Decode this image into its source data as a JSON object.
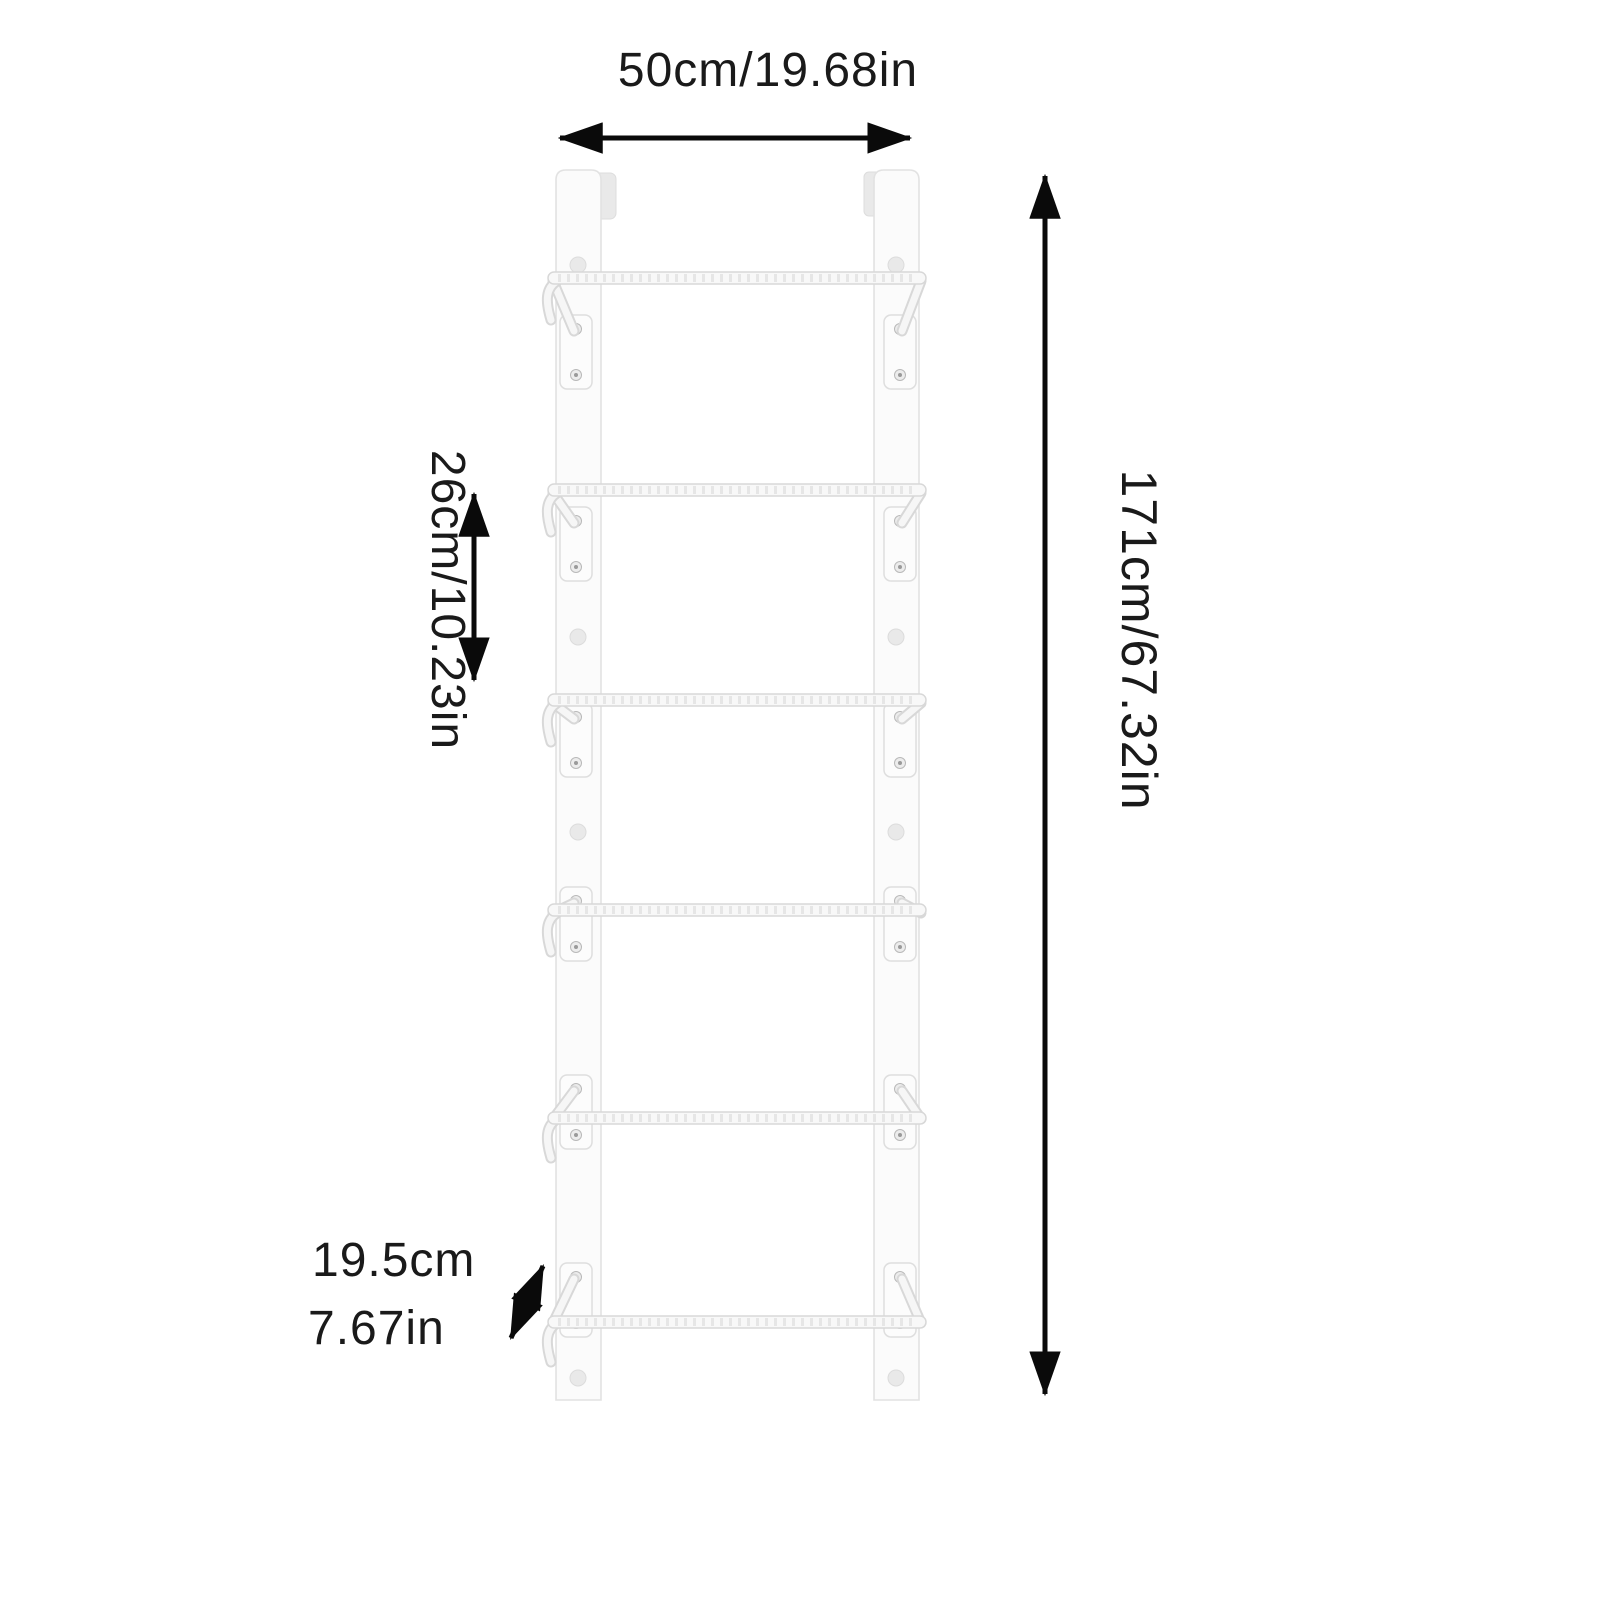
{
  "diagram": {
    "background_color": "#ffffff",
    "text_color": "#1a1a1a",
    "arrow_color": "#0a0a0a",
    "rack_fill_color": "#fafafa",
    "rack_outline_color": "#dedede",
    "rung_count": 6,
    "rail_count": 2,
    "holes_per_rail": 4,
    "labels": {
      "width": "50cm/19.68in",
      "height": "171cm/67.32in",
      "rung_spacing": "26cm/10.23in",
      "depth_cm": "19.5cm",
      "depth_in": "7.67in"
    },
    "values": {
      "width_cm": 50,
      "width_in": 19.68,
      "height_cm": 171,
      "height_in": 67.32,
      "rung_spacing_cm": 26,
      "rung_spacing_in": 10.23,
      "depth_cm": 19.5,
      "depth_in": 7.67
    }
  }
}
